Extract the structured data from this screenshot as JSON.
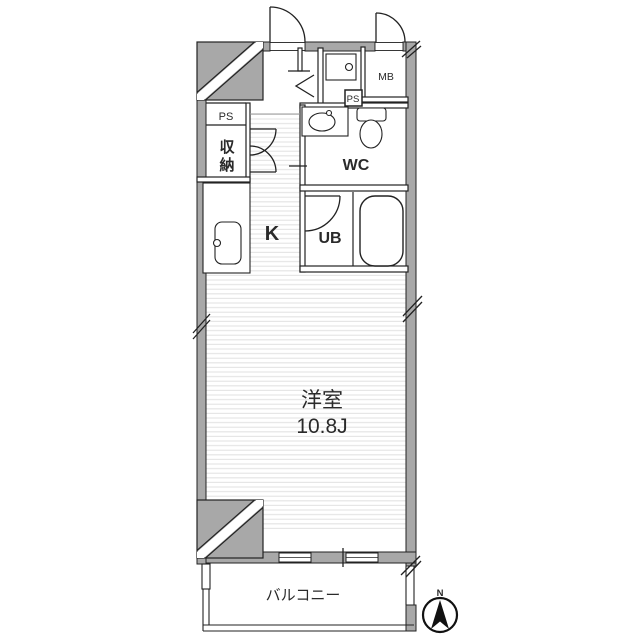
{
  "floorplan": {
    "type": "apartment-floor-plan",
    "rooms": {
      "ps_left": "PS",
      "storage_line1": "収",
      "storage_line2": "納",
      "kitchen": "K",
      "wc": "WC",
      "unit_bath": "UB",
      "meter_box": "MB",
      "ps_right": "PS",
      "main_room_name": "洋室",
      "main_room_size": "10.8J",
      "balcony": "バルコニー"
    },
    "compass": {
      "north_label": "N"
    },
    "colors": {
      "wall_gray": "#a8a8a8",
      "outline": "#222222",
      "floor_stripe": "#e3e3e3",
      "balcony_text": "#666666",
      "background": "#ffffff"
    }
  }
}
